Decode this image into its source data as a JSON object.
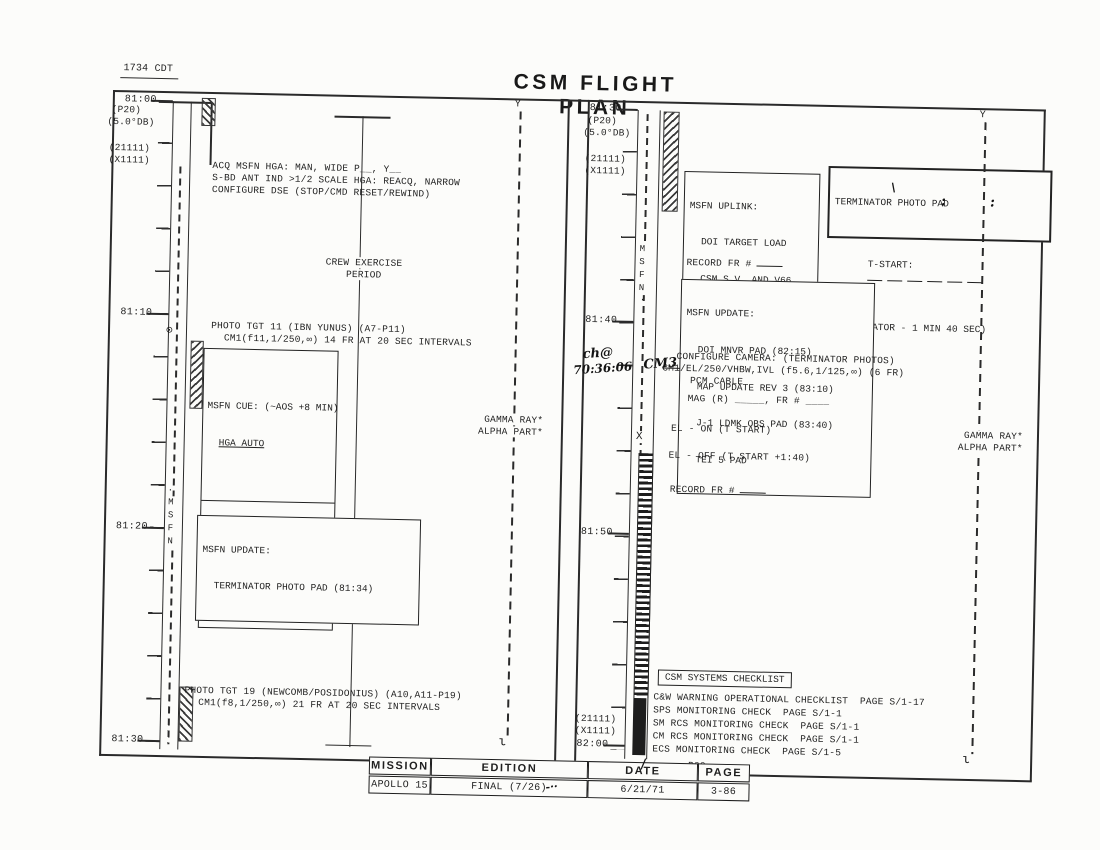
{
  "header": {
    "corner_time": "1734 CDT",
    "title": "CSM FLIGHT PLAN"
  },
  "icons": {
    "antenna": "Y",
    "squiggle": "ι",
    "orbit_marker": "⊙",
    "dot": "·"
  },
  "left_panel": {
    "ticks": [
      "81:00",
      "81:10",
      "81:20",
      "81:30"
    ],
    "flags": [
      "(P20)",
      "(5.0°DB)",
      "(21111)",
      "(X1111)"
    ],
    "msfn_track_label": "MSFN",
    "acq_lines": [
      "ACQ MSFN HGA: MAN, WIDE P__, Y__",
      "S-BD ANT IND >1/2 SCALE HGA: REACQ, NARROW",
      "CONFIGURE DSE (STOP/CMD RESET/REWIND)"
    ],
    "crew_exercise_line1": "CREW EXERCISE",
    "crew_exercise_line2": "PERIOD",
    "photo_tgt11_line1": "PHOTO TGT 11 (IBN YUNUS) (A7-P11)",
    "photo_tgt11_line2": "CM1(f11,1/250,∞) 14 FR AT 20 SEC INTERVALS",
    "msfn_cue_title": "MSFN CUE: (~AOS +8 MIN)",
    "msfn_cue_item": "HGA AUTO",
    "msfn_cmds_title": "MSFN CMDS: (AOS +9 MIN)",
    "msfn_cmds_item": "DSE PLAYBACK",
    "msfn_update_title": "MSFN UPDATE:",
    "msfn_update_item": "TERMINATOR PHOTO PAD (81:34)",
    "photo_tgt19_line1": "PHOTO TGT 19 (NEWCOMB/POSIDONIUS) (A10,A11-P19)",
    "photo_tgt19_line2": "CM1(f8,1/250,∞) 21 FR AT 20 SEC INTERVALS",
    "gamma_ray": "GAMMA RAY*",
    "alpha_part": "ALPHA PART*"
  },
  "right_panel": {
    "ticks": [
      "81:30",
      "81:40",
      "81:50",
      "82:00"
    ],
    "flags": [
      "(P20)",
      "(5.0°DB)",
      "(21111)",
      "(X1111)"
    ],
    "flags_bottom": [
      "(21111)",
      "(X1111)"
    ],
    "msfn_track_label": "MSFN",
    "x_marker": "X",
    "msfn_uplink": [
      "MSFN UPLINK:",
      "DOI TARGET LOAD",
      "CSM S.V. AND V66",
      "PIPA BIAS CHECK"
    ],
    "terminator_pad": {
      "title": "TERMINATOR PHOTO PAD",
      "t_start_label": "T-START:",
      "note": "(TERMINATOR - 1 MIN 40 SEC)"
    },
    "record_fr_1": "RECORD FR #",
    "msfn_update": [
      "MSFN UPDATE:",
      "DOI MNVR PAD (82:15)",
      "MAP UPDATE REV 3 (83:10)",
      "J-1 LDMK OBS PAD (83:40)",
      "TEI 5 PAD"
    ],
    "configure_camera_line1": "CONFIGURE CAMERA: (TERMINATOR PHOTOS)",
    "camera_crossed": "CM1",
    "camera_rest": "/EL/250/VHBW,IVL (f5.6,1/125,∞) (6 FR)",
    "pcm_cable": "PCM CABLE",
    "mag_line": "MAG (R) _____, FR # ____",
    "el_on": "EL - ON (T START)",
    "el_off": "EL - OFF (T START +1:40)",
    "record_fr_2": "RECORD FR #",
    "gamma_ray": "GAMMA RAY*",
    "alpha_part": "ALPHA PART*",
    "checklist_title": "CSM SYSTEMS CHECKLIST",
    "checklist": [
      "C&W WARNING OPERATIONAL CHECKLIST  PAGE S/1-17",
      "SPS MONITORING CHECK  PAGE S/1-1",
      "SM RCS MONITORING CHECK  PAGE S/1-1",
      "CM RCS MONITORING CHECK  PAGE S/1-1",
      "ECS MONITORING CHECK  PAGE S/1-5"
    ],
    "p00": "P00"
  },
  "handwriting": {
    "note_line1": "ch@",
    "note_line2": "70:36:06",
    "camera_mag": "CM3",
    "tstart_colon": ":",
    "tstart_tick": "\\",
    "date_slash": "/",
    "edition_mark": "-··"
  },
  "footer": {
    "headers": [
      "MISSION",
      "EDITION",
      "DATE",
      "PAGE"
    ],
    "values": [
      "APOLLO 15",
      "FINAL (7/26)",
      "6/21/71",
      "3-86"
    ]
  }
}
